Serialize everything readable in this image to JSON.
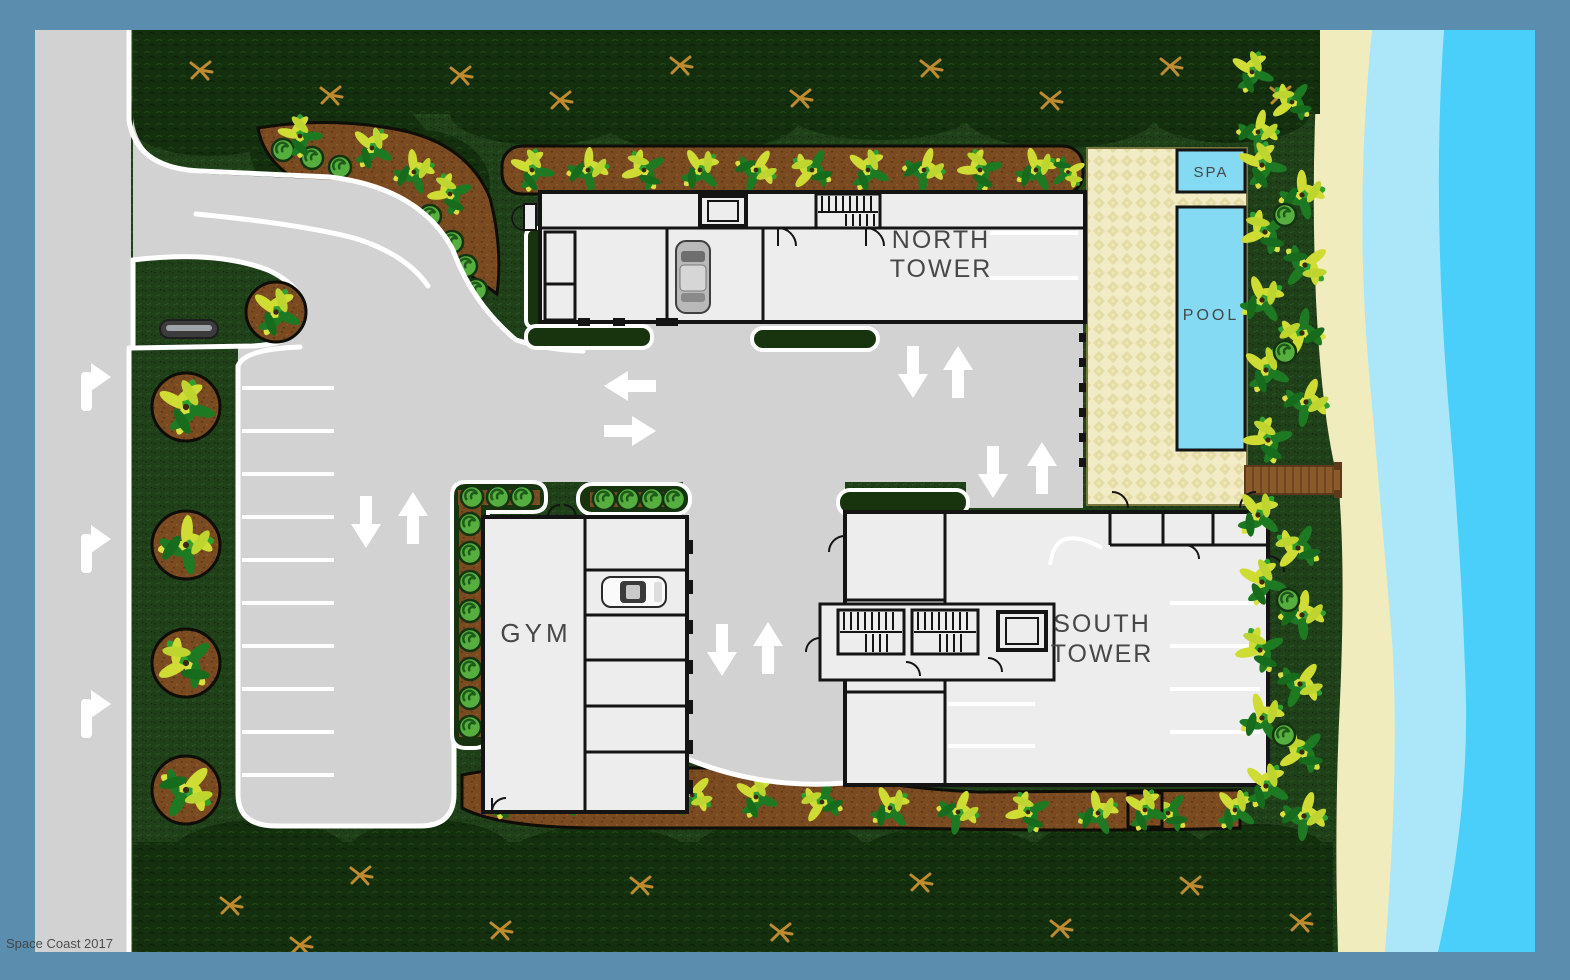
{
  "labels": {
    "north_tower_line1": "NORTH",
    "north_tower_line2": "TOWER",
    "south_tower_line1": "SOUTH",
    "south_tower_line2": "TOWER",
    "gym": "GYM",
    "pool": "POOL",
    "spa": "SPA"
  },
  "watermark": {
    "text": "Space Coast 2017"
  },
  "colors": {
    "frame": "#5A8DAE",
    "pavement": "#D2D2D2",
    "curb": "#FFFFFF",
    "grass": "#20401A",
    "canopy": "#132F0E",
    "mulch": "#7A4A21",
    "building_fill": "#EDEDED",
    "building_wall": "#141414",
    "pool_water": "#85DAF3",
    "deck": "#F1ECC5",
    "sand": "#F0ECBD",
    "shallow_water": "#ABE7F8",
    "ocean": "#4ACFFB",
    "boardwalk": "#8B5A2B",
    "label_text": "#474747"
  },
  "icons": {
    "traffic_arrows": [
      "turn-right",
      "turn-right",
      "turn-right",
      "left",
      "right",
      "down",
      "up",
      "down",
      "up",
      "down",
      "up",
      "down",
      "up"
    ],
    "vehicles": [
      "gray-car",
      "white-car"
    ],
    "site_features": [
      "bench",
      "stairs",
      "elevator",
      "palm-plant",
      "shrub",
      "boardwalk"
    ]
  }
}
